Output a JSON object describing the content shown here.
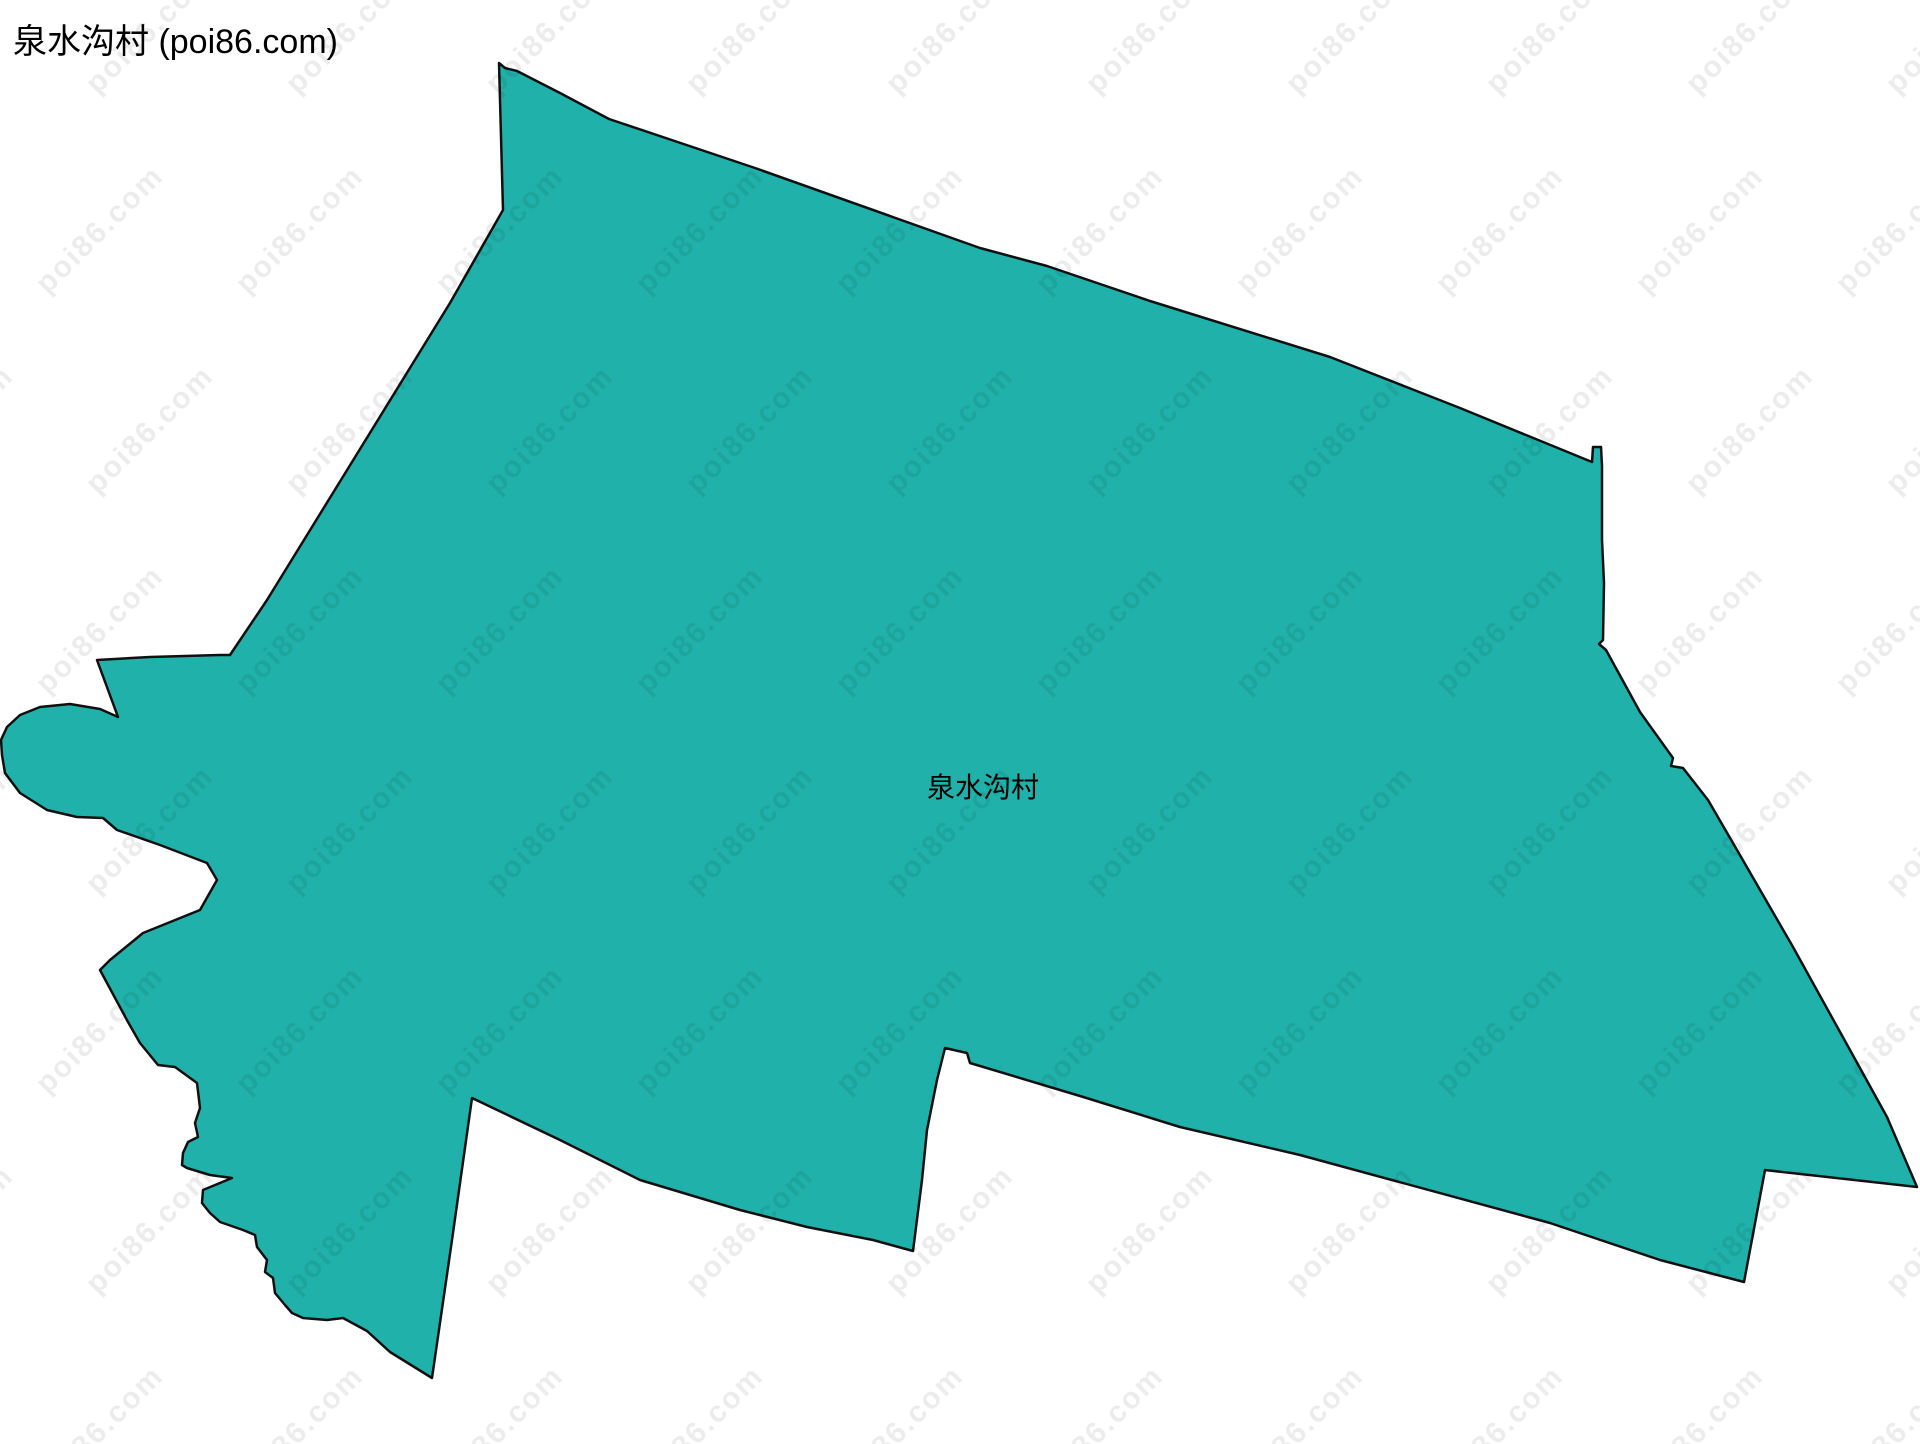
{
  "page": {
    "width": 1920,
    "height": 1444,
    "background_color": "#ffffff"
  },
  "header": {
    "title": "泉水沟村 (poi86.com)"
  },
  "map": {
    "region_name": "泉水沟村",
    "fill_color": "#20b2aa",
    "stroke_color": "#101010",
    "stroke_width": 2.5,
    "label": {
      "text": "泉水沟村",
      "x": 983,
      "y": 786,
      "font_size": 28,
      "color": "#000000"
    },
    "polygon_points": [
      [
        499,
        63
      ],
      [
        505,
        68
      ],
      [
        517,
        71
      ],
      [
        560,
        93
      ],
      [
        609,
        119
      ],
      [
        755,
        168
      ],
      [
        980,
        248
      ],
      [
        1047,
        266
      ],
      [
        1150,
        301
      ],
      [
        1330,
        357
      ],
      [
        1460,
        408
      ],
      [
        1592,
        462
      ],
      [
        1593,
        447
      ],
      [
        1601,
        447
      ],
      [
        1602,
        466
      ],
      [
        1602,
        540
      ],
      [
        1604,
        583
      ],
      [
        1603,
        640
      ],
      [
        1599,
        644
      ],
      [
        1606,
        650
      ],
      [
        1640,
        712
      ],
      [
        1673,
        758
      ],
      [
        1671,
        766
      ],
      [
        1683,
        768
      ],
      [
        1708,
        800
      ],
      [
        1737,
        850
      ],
      [
        1793,
        947
      ],
      [
        1850,
        1050
      ],
      [
        1887,
        1117
      ],
      [
        1917,
        1187
      ],
      [
        1765,
        1170
      ],
      [
        1744,
        1282
      ],
      [
        1660,
        1260
      ],
      [
        1550,
        1223
      ],
      [
        1300,
        1155
      ],
      [
        1180,
        1127
      ],
      [
        1080,
        1096
      ],
      [
        970,
        1063
      ],
      [
        967,
        1053
      ],
      [
        945,
        1048
      ],
      [
        937,
        1080
      ],
      [
        927,
        1130
      ],
      [
        922,
        1180
      ],
      [
        913,
        1251
      ],
      [
        873,
        1240
      ],
      [
        807,
        1227
      ],
      [
        740,
        1210
      ],
      [
        640,
        1180
      ],
      [
        560,
        1140
      ],
      [
        472,
        1098
      ],
      [
        452,
        1240
      ],
      [
        432,
        1378
      ],
      [
        390,
        1352
      ],
      [
        367,
        1331
      ],
      [
        343,
        1318
      ],
      [
        327,
        1320
      ],
      [
        303,
        1318
      ],
      [
        292,
        1313
      ],
      [
        285,
        1305
      ],
      [
        275,
        1293
      ],
      [
        273,
        1278
      ],
      [
        265,
        1272
      ],
      [
        267,
        1260
      ],
      [
        257,
        1247
      ],
      [
        255,
        1235
      ],
      [
        243,
        1230
      ],
      [
        220,
        1222
      ],
      [
        210,
        1213
      ],
      [
        202,
        1203
      ],
      [
        203,
        1190
      ],
      [
        232,
        1178
      ],
      [
        210,
        1175
      ],
      [
        187,
        1168
      ],
      [
        182,
        1165
      ],
      [
        183,
        1153
      ],
      [
        188,
        1142
      ],
      [
        198,
        1137
      ],
      [
        195,
        1123
      ],
      [
        200,
        1108
      ],
      [
        197,
        1083
      ],
      [
        175,
        1067
      ],
      [
        158,
        1065
      ],
      [
        140,
        1043
      ],
      [
        128,
        1022
      ],
      [
        100,
        970
      ],
      [
        110,
        960
      ],
      [
        143,
        933
      ],
      [
        200,
        910
      ],
      [
        217,
        880
      ],
      [
        207,
        863
      ],
      [
        160,
        845
      ],
      [
        117,
        830
      ],
      [
        103,
        818
      ],
      [
        77,
        817
      ],
      [
        47,
        810
      ],
      [
        20,
        793
      ],
      [
        5,
        773
      ],
      [
        2,
        755
      ],
      [
        1,
        740
      ],
      [
        7,
        727
      ],
      [
        20,
        715
      ],
      [
        40,
        707
      ],
      [
        70,
        704
      ],
      [
        100,
        709
      ],
      [
        118,
        717
      ],
      [
        97,
        660
      ],
      [
        150,
        657
      ],
      [
        220,
        655
      ],
      [
        230,
        655
      ],
      [
        267,
        600
      ],
      [
        450,
        303
      ],
      [
        503,
        210
      ]
    ]
  },
  "watermark": {
    "text": "poi86.com",
    "color": "rgba(0,0,0,0.075)",
    "font_size": 30,
    "rotation_deg": -45,
    "grid": {
      "x_start": -100,
      "x_step": 200,
      "x_end": 2100,
      "y_start": 30,
      "y_step": 200,
      "y_end": 1500,
      "stagger": 50
    }
  }
}
